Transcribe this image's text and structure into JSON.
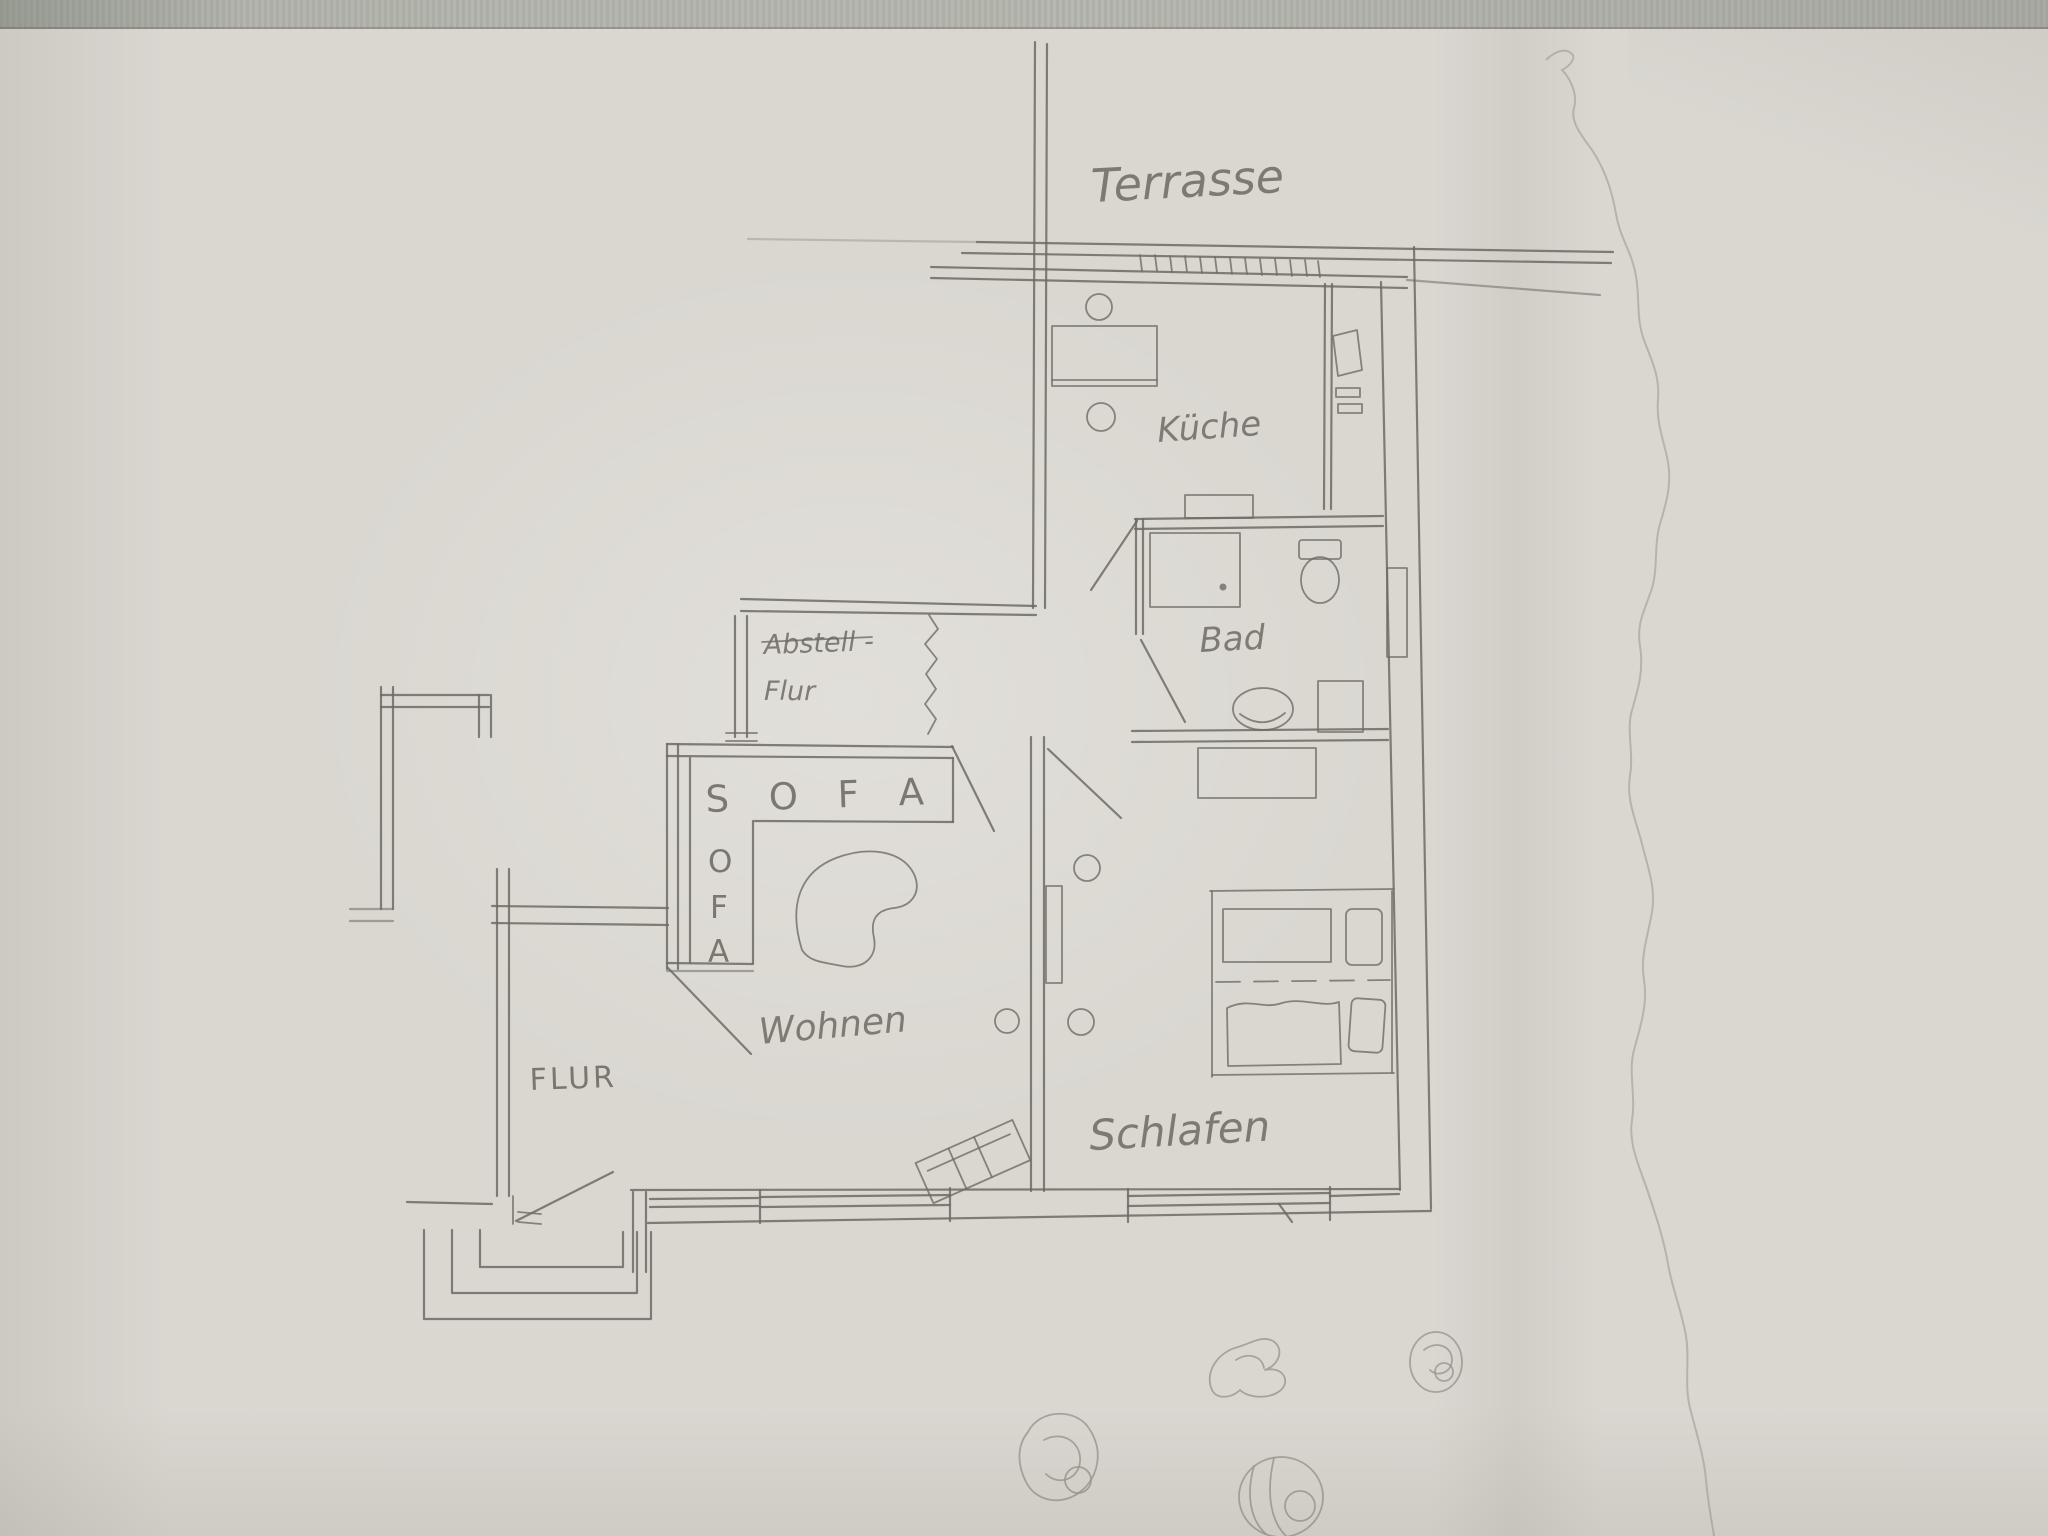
{
  "labels": {
    "terrace": "Terrasse",
    "kitchen": "Küche",
    "bath": "Bad",
    "storage_line1": "Abstell -",
    "storage_line2": "Flur",
    "sofa_horizontal": "S O F A",
    "sofa_vertical": [
      "O",
      "F",
      "A"
    ],
    "living": "Wohnen",
    "hall": "FLUR",
    "bedroom": "Schlafen"
  },
  "colors": {
    "paper": "#dad7d1",
    "fabric": "#b2b3ac",
    "pencil": "#6f6a64",
    "ink": "#6b665f"
  }
}
